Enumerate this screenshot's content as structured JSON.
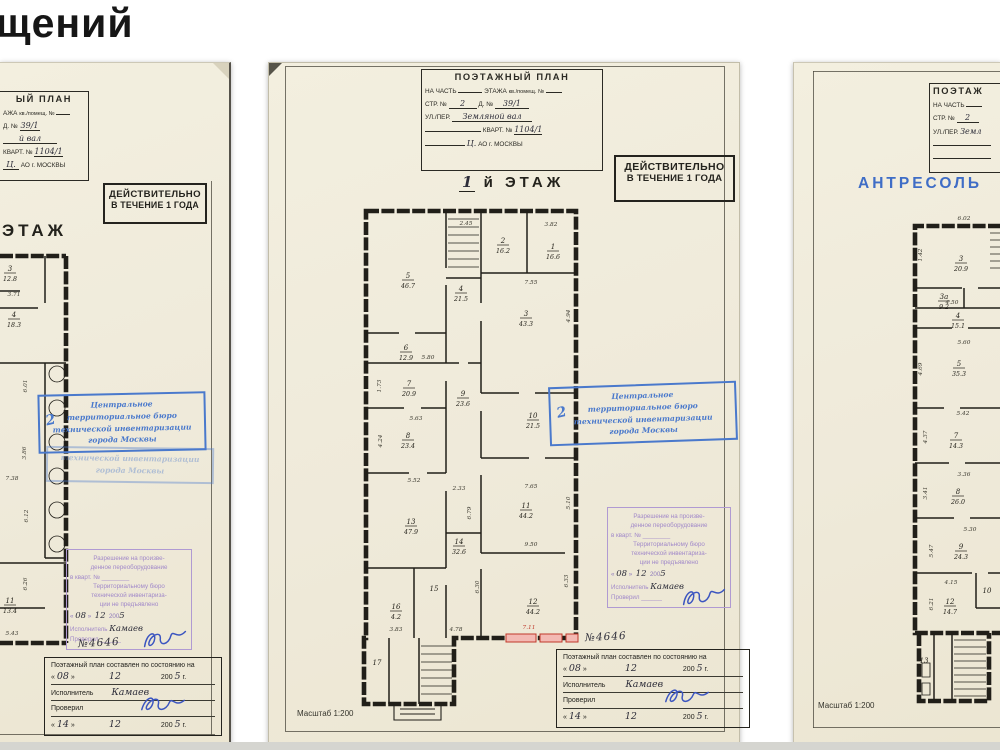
{
  "page": {
    "heading_fragment": "щений"
  },
  "shared": {
    "valid_stamp": {
      "line1": "ДЕЙСТВИТЕЛЬНО",
      "line2": "В ТЕЧЕНИЕ 1 ГОДА"
    },
    "blue_stamp": {
      "mark": "2",
      "lines": [
        "Центральное",
        "территориальное бюро",
        "технической инвентаризации",
        "города Москвы"
      ]
    },
    "purple_stamp": {
      "lines_top": [
        "Разрешение на произве-",
        "денное переоборудование",
        "в кварт. № ________"
      ],
      "lines_mid": [
        "Территориальному бюро",
        "технической инвентариза-",
        "ции не предъявлено"
      ],
      "date": {
        "q1": "«",
        "day": "08",
        "q2": "»",
        "month": "12",
        "year": "200",
        "y2": "5",
        "g": "г."
      },
      "executor_label": "Исполнитель",
      "executor_value": "Камаев",
      "checked_label": "Проверил",
      "blank": "______"
    },
    "footer_box": {
      "title": "Поэтажный план составлен по состоянию на",
      "date1": {
        "q1": "«",
        "day": "08",
        "q2": "»",
        "month": "12",
        "year": "200",
        "y2": "5",
        "g": "г."
      },
      "executor_label": "Исполнитель",
      "executor_value": "Камаев",
      "checked_label": "Проверил",
      "date2": {
        "q1": "«",
        "day": "14",
        "q2": "»",
        "month": "12",
        "year": "200",
        "y2": "5",
        "g": "г."
      }
    },
    "plan_number": "№4646",
    "scale_label": "Масштаб 1:200"
  },
  "left": {
    "title": {
      "heading": "ЫЙ ПЛАН",
      "row2a": "АЖА",
      "row2b": "кв./помещ. №",
      "d_label": "Д. №",
      "d_value": "39/1",
      "street_value": "й вал",
      "kvart_label": "КВАРТ. №",
      "kvart_value": "1104/1",
      "okrug_value": "Ц.",
      "okrug_label": "АО г. МОСКВЫ"
    },
    "floor_label": "ЭТАЖ",
    "plan": {
      "rooms": [
        {
          "no": "3",
          "area": "12.8",
          "x": 10,
          "y": 208
        },
        {
          "no": "4",
          "area": "18.3",
          "x": 14,
          "y": 254
        },
        {
          "no": "11",
          "area": "13.4",
          "x": 10,
          "y": 540
        }
      ],
      "dims": [
        {
          "t": "3.71",
          "x": 14,
          "y": 233
        },
        {
          "t": "6.01",
          "x": 27,
          "y": 323,
          "r": 1
        },
        {
          "t": "3.86",
          "x": 26,
          "y": 390,
          "r": 1
        },
        {
          "t": "7.38",
          "x": 12,
          "y": 417
        },
        {
          "t": "6.12",
          "x": 28,
          "y": 453,
          "r": 1
        },
        {
          "t": "6.26",
          "x": 27,
          "y": 521,
          "r": 1
        },
        {
          "t": "5.43",
          "x": 12,
          "y": 572
        }
      ]
    }
  },
  "middle": {
    "title": {
      "heading": "ПОЭТАЖНЫЙ ПЛАН",
      "row2a": "НА ЧАСТЬ",
      "row2b": "ЭТАЖА",
      "row2c": "кв./помещ. №",
      "str_label": "СТР. №",
      "str_value": "2",
      "d_label": "Д. №",
      "d_value": "39/1",
      "street_label": "УЛ./ПЕР.",
      "street_value": "Земляной вал",
      "kvart_label": "КВАРТ. №",
      "kvart_value": "1104/1",
      "okrug_value": "Ц.",
      "okrug_label": "АО г. МОСКВЫ"
    },
    "floor_hand": "1",
    "floor_label": "й ЭТАЖ",
    "plan": {
      "rooms": [
        {
          "no": "5",
          "area": "46.7",
          "x": 139,
          "y": 215
        },
        {
          "no": "2",
          "area": "16.2",
          "x": 234,
          "y": 180
        },
        {
          "no": "1",
          "area": "16.6",
          "x": 284,
          "y": 186
        },
        {
          "no": "4",
          "area": "21.5",
          "x": 192,
          "y": 228
        },
        {
          "no": "3",
          "area": "43.3",
          "x": 257,
          "y": 253
        },
        {
          "no": "6",
          "area": "12.9",
          "x": 137,
          "y": 287
        },
        {
          "no": "7",
          "area": "20.9",
          "x": 140,
          "y": 323
        },
        {
          "no": "8",
          "area": "23.4",
          "x": 139,
          "y": 375
        },
        {
          "no": "9",
          "area": "23.6",
          "x": 194,
          "y": 333
        },
        {
          "no": "10",
          "area": "21.5",
          "x": 264,
          "y": 355
        },
        {
          "no": "11",
          "area": "44.2",
          "x": 257,
          "y": 445
        },
        {
          "no": "13",
          "area": "47.9",
          "x": 142,
          "y": 461
        },
        {
          "no": "14",
          "area": "32.6",
          "x": 190,
          "y": 481
        },
        {
          "no": "12",
          "area": "44.2",
          "x": 264,
          "y": 541
        },
        {
          "no": "16",
          "area": "4.2",
          "x": 127,
          "y": 546
        },
        {
          "no": "15",
          "area": "",
          "x": 165,
          "y": 528
        },
        {
          "no": "17",
          "area": "",
          "x": 108,
          "y": 602
        }
      ],
      "dims": [
        {
          "t": "2.45",
          "x": 197,
          "y": 162
        },
        {
          "t": "3.82",
          "x": 282,
          "y": 163
        },
        {
          "t": "7.55",
          "x": 262,
          "y": 221
        },
        {
          "t": "4.94",
          "x": 301,
          "y": 253,
          "r": 1
        },
        {
          "t": "5.80",
          "x": 159,
          "y": 296
        },
        {
          "t": "1.73",
          "x": 112,
          "y": 323,
          "r": 1
        },
        {
          "t": "5.63",
          "x": 147,
          "y": 357
        },
        {
          "t": "4.24",
          "x": 113,
          "y": 378,
          "r": 1
        },
        {
          "t": "5.52",
          "x": 145,
          "y": 419
        },
        {
          "t": "2.33",
          "x": 190,
          "y": 427
        },
        {
          "t": "6.79",
          "x": 202,
          "y": 450,
          "r": 1
        },
        {
          "t": "7.65",
          "x": 262,
          "y": 425
        },
        {
          "t": "5.10",
          "x": 301,
          "y": 440,
          "r": 1
        },
        {
          "t": "9.50",
          "x": 262,
          "y": 483
        },
        {
          "t": "6.30",
          "x": 210,
          "y": 524,
          "r": 1
        },
        {
          "t": "6.33",
          "x": 299,
          "y": 518,
          "r": 1
        },
        {
          "t": "3.83",
          "x": 127,
          "y": 568
        },
        {
          "t": "4.78",
          "x": 187,
          "y": 568
        },
        {
          "t": "7.11",
          "x": 260,
          "y": 566,
          "red": true
        }
      ]
    }
  },
  "right": {
    "title": {
      "heading": "ПОЭТАЖ",
      "row2a": "НА ЧАСТЬ",
      "str_label": "СТР. №",
      "str_value": "2",
      "street_label": "УЛ./ПЕР.",
      "street_value": "Земл"
    },
    "floor_label": "АНТРЕСОЛЬ",
    "plan": {
      "rooms": [
        {
          "no": "3",
          "area": "20.9",
          "x": 167,
          "y": 198
        },
        {
          "no": "3а",
          "area": "9.2",
          "x": 150,
          "y": 236
        },
        {
          "no": "4",
          "area": "15.1",
          "x": 164,
          "y": 255
        },
        {
          "no": "5",
          "area": "35.3",
          "x": 165,
          "y": 303
        },
        {
          "no": "7",
          "area": "14.3",
          "x": 162,
          "y": 375
        },
        {
          "no": "8",
          "area": "26.0",
          "x": 164,
          "y": 431
        },
        {
          "no": "9",
          "area": "24.3",
          "x": 167,
          "y": 486
        },
        {
          "no": "12",
          "area": "14.7",
          "x": 156,
          "y": 541
        },
        {
          "no": "10",
          "area": "",
          "x": 193,
          "y": 530
        },
        {
          "no": "13",
          "area": "",
          "x": 130,
          "y": 600
        }
      ],
      "dims": [
        {
          "t": "6.02",
          "x": 170,
          "y": 157
        },
        {
          "t": "1.42",
          "x": 128,
          "y": 192,
          "r": 1
        },
        {
          "t": "4.50",
          "x": 158,
          "y": 241
        },
        {
          "t": "5.60",
          "x": 170,
          "y": 281
        },
        {
          "t": "4.69",
          "x": 128,
          "y": 306,
          "r": 1
        },
        {
          "t": "5.42",
          "x": 169,
          "y": 352
        },
        {
          "t": "4.37",
          "x": 133,
          "y": 374,
          "r": 1
        },
        {
          "t": "3.36",
          "x": 170,
          "y": 413
        },
        {
          "t": "3.41",
          "x": 133,
          "y": 430,
          "r": 1
        },
        {
          "t": "5.30",
          "x": 176,
          "y": 468
        },
        {
          "t": "5.47",
          "x": 139,
          "y": 488,
          "r": 1
        },
        {
          "t": "4.15",
          "x": 157,
          "y": 521
        },
        {
          "t": "6.21",
          "x": 139,
          "y": 541,
          "r": 1
        }
      ]
    }
  }
}
